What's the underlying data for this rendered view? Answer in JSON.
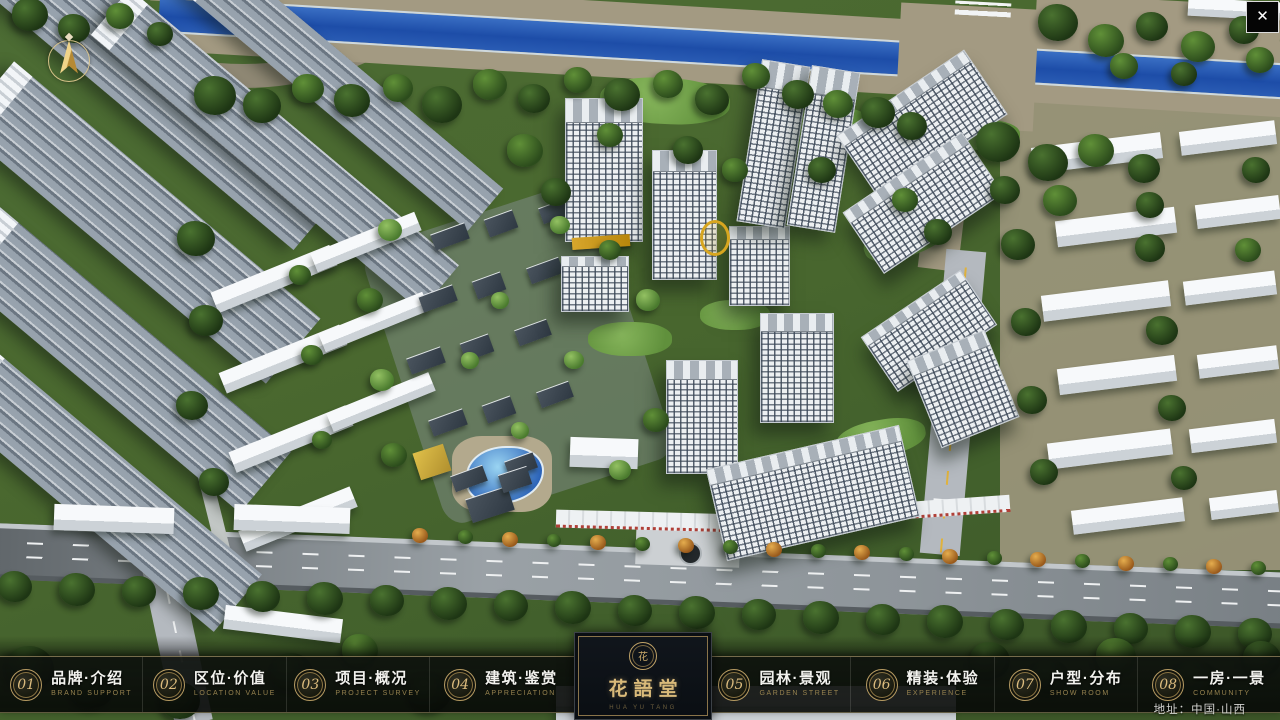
{
  "theme": {
    "gold": "#c9a96a",
    "bar_bg": "#0b0f0b",
    "panel_bg": "#0d1217",
    "river_blue": "#1d4da8"
  },
  "ui": {
    "close_glyph": "✕"
  },
  "nav": {
    "items": [
      {
        "num": "01",
        "zh": "品牌·介绍",
        "en": "BRAND SUPPORT"
      },
      {
        "num": "02",
        "zh": "区位·价值",
        "en": "LOCATION VALUE"
      },
      {
        "num": "03",
        "zh": "项目·概况",
        "en": "PROJECT SURVEY"
      },
      {
        "num": "04",
        "zh": "建筑·鉴赏",
        "en": "APPRECIATION"
      },
      {
        "num": "05",
        "zh": "园林·景观",
        "en": "GARDEN STREET"
      },
      {
        "num": "06",
        "zh": "精装·体验",
        "en": "EXPERIENCE"
      },
      {
        "num": "07",
        "zh": "户型·分布",
        "en": "SHOW ROOM"
      },
      {
        "num": "08",
        "zh": "一房·一景",
        "en": "COMMUNITY"
      }
    ]
  },
  "logo": {
    "seal_char": "花",
    "title": "花語堂",
    "subtitle": "HUA YU TANG"
  },
  "footer": {
    "address": "地址：中国·山西"
  }
}
